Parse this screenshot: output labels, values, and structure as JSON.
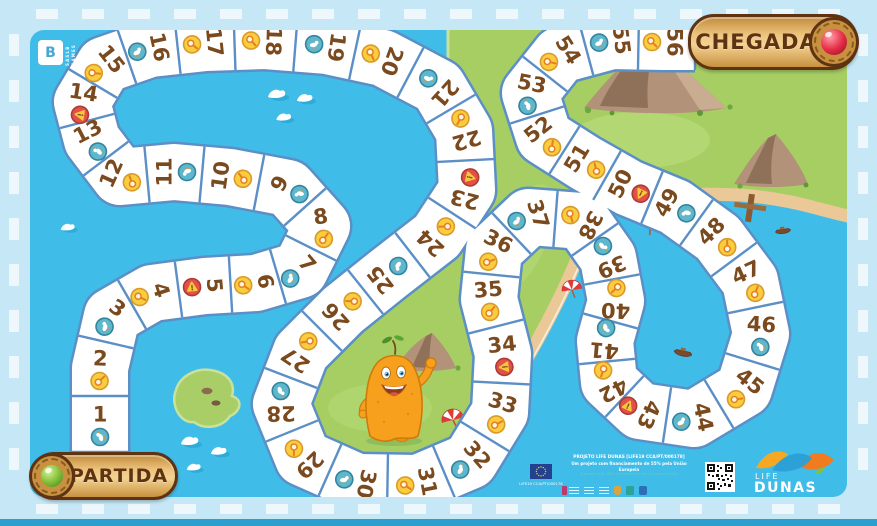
{
  "board": {
    "start_label": "PARTIDA",
    "finish_label": "CHEGADA",
    "publisher": {
      "glyph": "B",
      "vertical_text": [
        "SASLB",
        "GAMES"
      ]
    },
    "cells": [
      {
        "n": 1,
        "icon": "bird",
        "x": 100,
        "y": 424,
        "rot": -90
      },
      {
        "n": 2,
        "icon": "magnifier",
        "x": 100,
        "y": 368,
        "rot": -88
      },
      {
        "n": 3,
        "icon": "bird",
        "x": 112,
        "y": 316,
        "rot": -55
      },
      {
        "n": 4,
        "icon": "magnifier",
        "x": 152,
        "y": 293,
        "rot": -18
      },
      {
        "n": 5,
        "icon": "warning",
        "x": 205,
        "y": 286,
        "rot": -5
      },
      {
        "n": 6,
        "icon": "magnifier",
        "x": 256,
        "y": 283,
        "rot": -10
      },
      {
        "n": 7,
        "icon": "bird",
        "x": 300,
        "y": 270,
        "rot": -41
      },
      {
        "n": 8,
        "icon": "magnifier",
        "x": 322,
        "y": 226,
        "rot": -98
      },
      {
        "n": 9,
        "icon": "bird",
        "x": 288,
        "y": 188,
        "rot": -152
      },
      {
        "n": 10,
        "icon": "magnifier",
        "x": 230,
        "y": 177,
        "rot": -172
      },
      {
        "n": 11,
        "icon": "bird",
        "x": 174,
        "y": 172,
        "rot": 180
      },
      {
        "n": 12,
        "icon": "magnifier",
        "x": 120,
        "y": 177,
        "rot": -156
      },
      {
        "n": 13,
        "icon": "bird",
        "x": 92,
        "y": 140,
        "rot": -117
      },
      {
        "n": 14,
        "icon": "warning",
        "x": 82,
        "y": 102,
        "rot": -81
      },
      {
        "n": 15,
        "icon": "magnifier",
        "x": 104,
        "y": 65,
        "rot": -38
      },
      {
        "n": 16,
        "icon": "bird",
        "x": 150,
        "y": 49,
        "rot": -12
      },
      {
        "n": 17,
        "icon": "magnifier",
        "x": 205,
        "y": 43,
        "rot": -6
      },
      {
        "n": 18,
        "icon": "magnifier",
        "x": 264,
        "y": 41,
        "rot": 2
      },
      {
        "n": 19,
        "icon": "bird",
        "x": 327,
        "y": 46,
        "rot": 8
      },
      {
        "n": 20,
        "icon": "magnifier",
        "x": 383,
        "y": 58,
        "rot": 20
      },
      {
        "n": 21,
        "icon": "bird",
        "x": 438,
        "y": 87,
        "rot": 42
      },
      {
        "n": 22,
        "icon": "magnifier",
        "x": 464,
        "y": 131,
        "rot": 74
      },
      {
        "n": 23,
        "icon": "warning",
        "x": 467,
        "y": 190,
        "rot": 104
      },
      {
        "n": 24,
        "icon": "magnifier",
        "x": 437,
        "y": 236,
        "rot": 133
      },
      {
        "n": 25,
        "icon": "bird",
        "x": 388,
        "y": 274,
        "rot": 142
      },
      {
        "n": 26,
        "icon": "magnifier",
        "x": 343,
        "y": 310,
        "rot": 138
      },
      {
        "n": 27,
        "icon": "magnifier",
        "x": 301,
        "y": 352,
        "rot": 124
      },
      {
        "n": 28,
        "icon": "bird",
        "x": 281,
        "y": 404,
        "rot": 89
      },
      {
        "n": 29,
        "icon": "magnifier",
        "x": 303,
        "y": 458,
        "rot": 46
      },
      {
        "n": 30,
        "icon": "bird",
        "x": 357,
        "y": 482,
        "rot": 12
      },
      {
        "n": 31,
        "icon": "magnifier",
        "x": 418,
        "y": 483,
        "rot": -11
      },
      {
        "n": 32,
        "icon": "bird",
        "x": 470,
        "y": 461,
        "rot": -41
      },
      {
        "n": 33,
        "icon": "magnifier",
        "x": 500,
        "y": 412,
        "rot": -73
      },
      {
        "n": 34,
        "icon": "warning",
        "x": 503,
        "y": 354,
        "rot": -96
      },
      {
        "n": 35,
        "icon": "magnifier",
        "x": 489,
        "y": 299,
        "rot": -95
      },
      {
        "n": 36,
        "icon": "magnifier",
        "x": 494,
        "y": 250,
        "rot": -64
      },
      {
        "n": 37,
        "icon": "bird",
        "x": 529,
        "y": 217,
        "rot": -18
      },
      {
        "n": 38,
        "icon": "magnifier",
        "x": 582,
        "y": 221,
        "rot": 27
      },
      {
        "n": 39,
        "icon": "bird",
        "x": 608,
        "y": 258,
        "rot": 67
      },
      {
        "n": 40,
        "icon": "magnifier",
        "x": 616,
        "y": 301,
        "rot": 92
      },
      {
        "n": 41,
        "icon": "bird",
        "x": 605,
        "y": 341,
        "rot": 95
      },
      {
        "n": 42,
        "icon": "magnifier",
        "x": 609,
        "y": 382,
        "rot": 63
      },
      {
        "n": 43,
        "icon": "warning",
        "x": 640,
        "y": 411,
        "rot": 24
      },
      {
        "n": 44,
        "icon": "bird",
        "x": 694,
        "y": 419,
        "rot": -12
      },
      {
        "n": 45,
        "icon": "magnifier",
        "x": 744,
        "y": 389,
        "rot": -52
      },
      {
        "n": 46,
        "icon": "bird",
        "x": 761,
        "y": 334,
        "rot": -87
      },
      {
        "n": 47,
        "icon": "magnifier",
        "x": 750,
        "y": 281,
        "rot": -114
      },
      {
        "n": 48,
        "icon": "magnifier",
        "x": 718,
        "y": 238,
        "rot": -135
      },
      {
        "n": 49,
        "icon": "bird",
        "x": 675,
        "y": 207,
        "rot": -151
      },
      {
        "n": 50,
        "icon": "warning",
        "x": 629,
        "y": 188,
        "rot": -154
      },
      {
        "n": 51,
        "icon": "magnifier",
        "x": 585,
        "y": 163,
        "rot": -149
      },
      {
        "n": 52,
        "icon": "magnifier",
        "x": 544,
        "y": 137,
        "rot": -128
      },
      {
        "n": 53,
        "icon": "bird",
        "x": 530,
        "y": 93,
        "rot": -79
      },
      {
        "n": 54,
        "icon": "magnifier",
        "x": 560,
        "y": 55,
        "rot": -32
      },
      {
        "n": 55,
        "icon": "bird",
        "x": 612,
        "y": 41,
        "rot": -7
      },
      {
        "n": 56,
        "icon": "magnifier",
        "x": 665,
        "y": 42,
        "rot": 0
      }
    ]
  },
  "footer": {
    "project_line1": "PROJETO LIFE DUNAS [LIFE19 CCA/PT/000178]",
    "project_line2": "Um projeto com financiamento de 55% pela União Europeia",
    "project_line3": "A project with 55% funding from the European Union",
    "eu_ref": "LIFE19 CCA/PT/000178",
    "logo": {
      "top": "LIFE",
      "bottom": "DUNAS"
    }
  },
  "colors": {
    "sea": "#40BCE8",
    "frame": "#C6E7F5",
    "frame_dash": "#EDF7FC",
    "land": "#A6CE63",
    "beach": "#EBC897",
    "track_border": "#5B8FC6",
    "number": "#7A4A1E",
    "icon_magnifier": "#F9CD3D",
    "icon_bird": "#5FB7CE",
    "icon_warning": "#E25048",
    "banner_wood": "#C89140",
    "gem_start": "#7CC142",
    "gem_finish": "#E8304A",
    "bottom_strip": "#2BA0CE"
  }
}
